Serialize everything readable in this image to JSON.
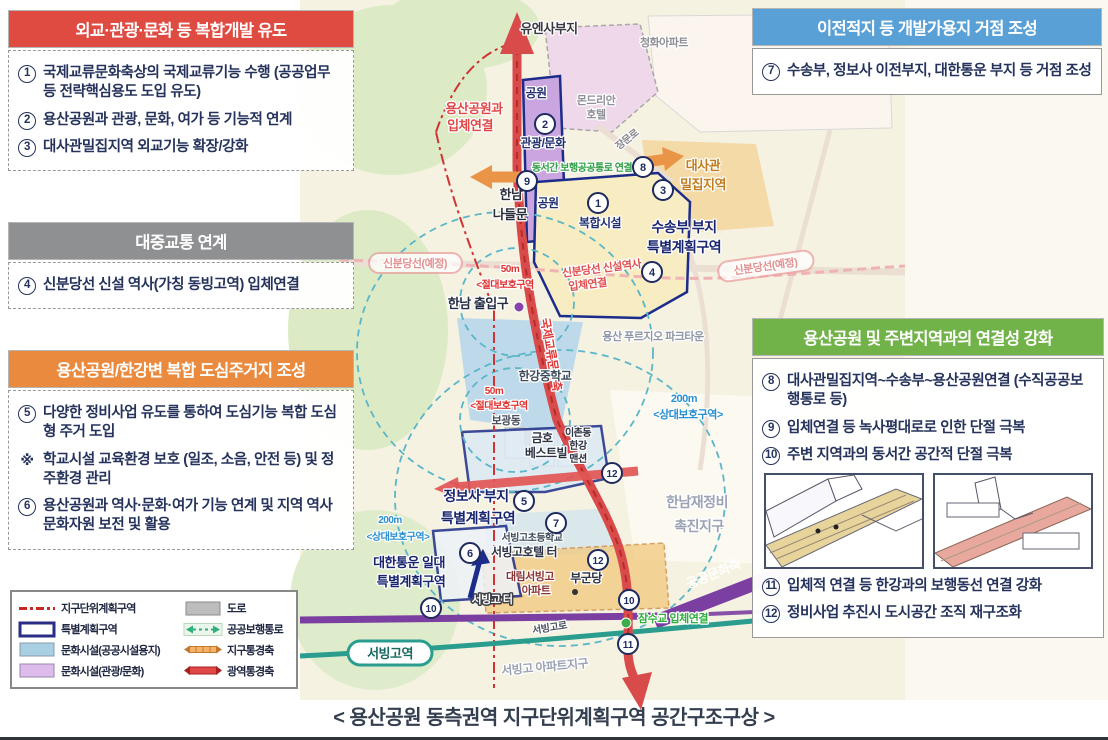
{
  "caption": "< 용산공원 동측권역 지구단위계획구역 공간구조구상 >",
  "colors": {
    "red_title": "#df4a41",
    "gray_title": "#8f9092",
    "orange_title": "#e98a3e",
    "blue_title": "#58a0d6",
    "green_title": "#71b249",
    "body_text": "#25335c",
    "special_zone_border": "#1c2c8a",
    "wide_axis_red": "#d94a4a",
    "district_axis_orange": "#ea9448",
    "rail_purple": "#7b3fa2",
    "line_teal": "#2a9d8f"
  },
  "panels": {
    "diplomacy": {
      "title": "외교·관광·문화 등 복합개발 유도",
      "items": [
        {
          "num": "①",
          "text": "국제교류문화축상의 국제교류기능 수행 (공공업무 등 전략핵심용도 도입 유도)"
        },
        {
          "num": "②",
          "text": "용산공원과 관광, 문화, 여가 등 기능적 연계"
        },
        {
          "num": "③",
          "text": "대사관밀집지역 외교기능 확장/강화"
        }
      ]
    },
    "transit": {
      "title": "대중교통 연계",
      "items": [
        {
          "num": "④",
          "text": "신분당선 신설 역사(가칭 동빙고역) 입체연결"
        }
      ]
    },
    "housing": {
      "title": "용산공원/한강변 복합 도심주거지 조성",
      "items": [
        {
          "num": "⑤",
          "text": "다양한 정비사업 유도를 통하여 도심기능 복합 도심형 주거 도입"
        },
        {
          "num": "※",
          "text": "학교시설 교육환경 보호 (일조, 소음, 안전 등) 및 정주환경 관리"
        },
        {
          "num": "⑥",
          "text": "용산공원과 역사·문화·여가 기능 연계 및 지역 역사문화자원 보전 및 활용"
        }
      ]
    },
    "relocation": {
      "title": "이전적지 등 개발가용지 거점 조성",
      "items": [
        {
          "num": "⑦",
          "text": "수송부, 정보사 이전부지, 대한통운 부지 등 거점 조성"
        }
      ]
    },
    "connectivity": {
      "title": "용산공원 및 주변지역과의 연결성 강화",
      "items": [
        {
          "num": "⑧",
          "text": "대사관밀집지역~수송부~용산공원연결 (수직공공보행통로 등)"
        },
        {
          "num": "⑨",
          "text": "입체연결 등 녹사평대로로 인한 단절 극복"
        },
        {
          "num": "⑩",
          "text": "주변 지역과의 동서간 공간적 단절 극복"
        }
      ],
      "items_after": [
        {
          "num": "⑪",
          "text": "입체적 연결 등 한강과의 보행동선 연결 강화"
        },
        {
          "num": "⑫",
          "text": "정비사업 추진시 도시공간 조직 재구조화"
        }
      ]
    }
  },
  "legend": {
    "entries": [
      {
        "symbol": "dash-red",
        "label": "지구단위계획구역"
      },
      {
        "symbol": "rect-gray",
        "label": "도로"
      },
      {
        "symbol": "rect-navy",
        "label": "특별계획구역"
      },
      {
        "symbol": "arrow-green",
        "label": "공공보행통로"
      },
      {
        "symbol": "rect-lightblue",
        "label": "문화시설(공공시설용지)"
      },
      {
        "symbol": "band-orange",
        "label": "지구통경축"
      },
      {
        "symbol": "rect-violet",
        "label": "문화시설(관광/문화)"
      },
      {
        "symbol": "band-red",
        "label": "광역통경축"
      }
    ]
  },
  "map": {
    "labels": [
      {
        "t": "유엔사부지",
        "x": 549,
        "y": 33,
        "c": "#3a3a42",
        "s": 13
      },
      {
        "t": "청화아파트",
        "x": 664,
        "y": 46,
        "c": "#8f8f96",
        "s": 11
      },
      {
        "t": "몬드리안",
        "x": 596,
        "y": 104,
        "c": "#90909a",
        "s": 11
      },
      {
        "t": "호텔",
        "x": 596,
        "y": 118,
        "c": "#90909a",
        "s": 11
      },
      {
        "t": "공원",
        "x": 536,
        "y": 97,
        "c": "#223070",
        "s": 12
      },
      {
        "t": "용산공원과",
        "x": 474,
        "y": 113,
        "c": "#e04848",
        "s": 13
      },
      {
        "t": "입체연결",
        "x": 470,
        "y": 130,
        "c": "#e04848",
        "s": 13
      },
      {
        "t": "관광/문화",
        "x": 543,
        "y": 147,
        "c": "#223070",
        "s": 12
      },
      {
        "t": "장문로",
        "x": 629,
        "y": 142,
        "c": "#85858d",
        "s": 10,
        "r": -38
      },
      {
        "t": "대사관",
        "x": 703,
        "y": 170,
        "c": "#c07c1e",
        "s": 13
      },
      {
        "t": "밀집지역",
        "x": 703,
        "y": 189,
        "c": "#c07c1e",
        "s": 13
      },
      {
        "t": "동서간 보행공공통로 연결",
        "x": 582,
        "y": 171,
        "c": "#2f9e44",
        "s": 10
      },
      {
        "t": "한남",
        "x": 511,
        "y": 199,
        "c": "#2a2e3a",
        "s": 13
      },
      {
        "t": "나들문",
        "x": 510,
        "y": 219,
        "c": "#2a2e3a",
        "s": 13
      },
      {
        "t": "공원",
        "x": 548,
        "y": 207,
        "c": "#223070",
        "s": 12
      },
      {
        "t": "복합시설",
        "x": 600,
        "y": 227,
        "c": "#223070",
        "s": 12
      },
      {
        "t": "수송부 부지",
        "x": 684,
        "y": 232,
        "c": "#18246e",
        "s": 14
      },
      {
        "t": "특별계획구역",
        "x": 684,
        "y": 252,
        "c": "#18246e",
        "s": 14
      },
      {
        "t": "신분당선(예정)",
        "x": 415,
        "y": 267,
        "c": "#e39191",
        "s": 11
      },
      {
        "t": "신분당선(예정)",
        "x": 766,
        "y": 270,
        "c": "#e39191",
        "s": 11,
        "r": -8
      },
      {
        "t": "신분당선 신설역사",
        "x": 602,
        "y": 272,
        "c": "#e05050",
        "s": 11,
        "r": -7
      },
      {
        "t": "입체연결",
        "x": 588,
        "y": 288,
        "c": "#e05050",
        "s": 11,
        "r": -7
      },
      {
        "t": "50m",
        "x": 510,
        "y": 272,
        "c": "#e03030",
        "s": 10
      },
      {
        "t": "<절대보호구역",
        "x": 505,
        "y": 288,
        "c": "#e03030",
        "s": 10
      },
      {
        "t": "한남 출입구",
        "x": 478,
        "y": 308,
        "c": "#232c42",
        "s": 13
      },
      {
        "t": "국제교류문화축",
        "x": 547,
        "y": 355,
        "c": "#e03838",
        "s": 12,
        "r": 80
      },
      {
        "t": "한강중학교",
        "x": 545,
        "y": 380,
        "c": "#3c4c5c",
        "s": 12
      },
      {
        "t": "용산 푸르지오 파크타운",
        "x": 653,
        "y": 340,
        "c": "#8e96a6",
        "s": 11
      },
      {
        "t": "200m",
        "x": 684,
        "y": 402,
        "c": "#2a8fd0",
        "s": 11
      },
      {
        "t": "<상대보호구역>",
        "x": 688,
        "y": 418,
        "c": "#2a8fd0",
        "s": 11
      },
      {
        "t": "50m",
        "x": 494,
        "y": 394,
        "c": "#e03030",
        "s": 10
      },
      {
        "t": "<절대보호구역",
        "x": 499,
        "y": 409,
        "c": "#e03030",
        "s": 10
      },
      {
        "t": "보광동",
        "x": 506,
        "y": 424,
        "c": "#4a505e",
        "s": 11
      },
      {
        "t": "금호",
        "x": 542,
        "y": 442,
        "c": "#2c3242",
        "s": 12
      },
      {
        "t": "베스트빌",
        "x": 546,
        "y": 457,
        "c": "#2c3242",
        "s": 12
      },
      {
        "t": "이촌동",
        "x": 578,
        "y": 436,
        "c": "#2c3242",
        "s": 10
      },
      {
        "t": "한강",
        "x": 578,
        "y": 449,
        "c": "#2c3242",
        "s": 10
      },
      {
        "t": "맨션",
        "x": 578,
        "y": 462,
        "c": "#2c3242",
        "s": 10
      },
      {
        "t": "정보사 부지",
        "x": 476,
        "y": 501,
        "c": "#18246e",
        "s": 14
      },
      {
        "t": "특별계획구역",
        "x": 478,
        "y": 523,
        "c": "#18246e",
        "s": 14
      },
      {
        "t": "한남재정비",
        "x": 697,
        "y": 507,
        "c": "#9aa2b4",
        "s": 14
      },
      {
        "t": "촉진지구",
        "x": 699,
        "y": 531,
        "c": "#9aa2b4",
        "s": 14
      },
      {
        "t": "200m",
        "x": 390,
        "y": 523,
        "c": "#2a8fd0",
        "s": 10
      },
      {
        "t": "<상대보호구역>",
        "x": 398,
        "y": 540,
        "c": "#2a8fd0",
        "s": 10
      },
      {
        "t": "서빙고초등학교",
        "x": 532,
        "y": 541,
        "c": "#3c4c5c",
        "s": 10
      },
      {
        "t": "서빙고호텔 터",
        "x": 524,
        "y": 556,
        "c": "#2c3242",
        "s": 12
      },
      {
        "t": "대한통운 일대",
        "x": 409,
        "y": 567,
        "c": "#18246e",
        "s": 13
      },
      {
        "t": "특별계획구역",
        "x": 411,
        "y": 586,
        "c": "#18246e",
        "s": 13
      },
      {
        "t": "대림서빙고",
        "x": 530,
        "y": 580,
        "c": "#8a3434",
        "s": 11
      },
      {
        "t": "아파트",
        "x": 536,
        "y": 594,
        "c": "#8a3434",
        "s": 11
      },
      {
        "t": "부군당",
        "x": 586,
        "y": 582,
        "c": "#2c3242",
        "s": 12
      },
      {
        "t": "서빙고 터",
        "x": 492,
        "y": 603,
        "c": "#ffffff",
        "s": 11,
        "hd": 1
      },
      {
        "t": "서빙고로",
        "x": 550,
        "y": 631,
        "c": "#4a505e",
        "s": 10,
        "r": -9
      },
      {
        "t": "서빙고역",
        "x": 390,
        "y": 658,
        "c": "#17695f",
        "s": 13
      },
      {
        "t": "서빙고 아파트지구",
        "x": 545,
        "y": 671,
        "c": "#9aa2b4",
        "s": 12,
        "r": -5
      },
      {
        "t": "공공문화축",
        "x": 715,
        "y": 578,
        "c": "#ffffff",
        "s": 13,
        "r": -22,
        "nh": 1
      },
      {
        "t": "잠수교 입체연결",
        "x": 673,
        "y": 622,
        "c": "#2fae3e",
        "s": 11
      }
    ],
    "markers": [
      {
        "n": "1",
        "x": 598,
        "y": 203
      },
      {
        "n": "2",
        "x": 545,
        "y": 124
      },
      {
        "n": "3",
        "x": 663,
        "y": 190
      },
      {
        "n": "4",
        "x": 652,
        "y": 272
      },
      {
        "n": "5",
        "x": 524,
        "y": 501
      },
      {
        "n": "6",
        "x": 470,
        "y": 553
      },
      {
        "n": "7",
        "x": 556,
        "y": 523
      },
      {
        "n": "8",
        "x": 643,
        "y": 167
      },
      {
        "n": "9",
        "x": 527,
        "y": 181
      },
      {
        "n": "10",
        "x": 431,
        "y": 608
      },
      {
        "n": "10",
        "x": 629,
        "y": 600
      },
      {
        "n": "11",
        "x": 628,
        "y": 644
      },
      {
        "n": "12",
        "x": 612,
        "y": 473
      },
      {
        "n": "12",
        "x": 598,
        "y": 560
      }
    ]
  }
}
